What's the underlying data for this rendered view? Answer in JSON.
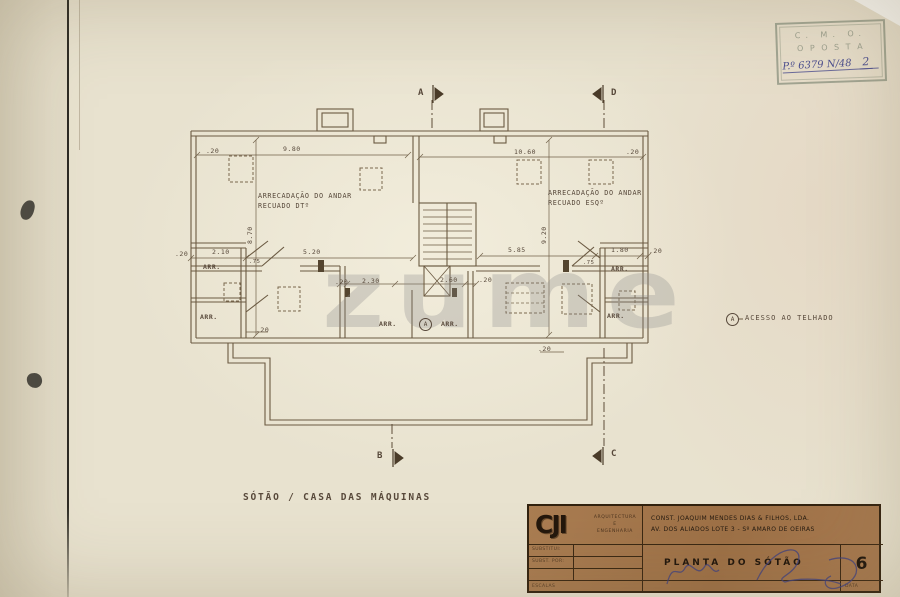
{
  "watermark": {
    "text": "zume"
  },
  "stamp": {
    "line1": "C. M. O.",
    "line2": "O P O S T A",
    "handwritten": "P.º 6379 N/48",
    "number": "2"
  },
  "plan": {
    "texts": [
      {
        "n": "dimension-label",
        "t": ".20",
        "x": 206,
        "y": 147
      },
      {
        "n": "dimension-label",
        "t": "9.80",
        "x": 283,
        "y": 145
      },
      {
        "n": "dimension-label",
        "t": "10.60",
        "x": 514,
        "y": 148
      },
      {
        "n": "dimension-label",
        "t": ".20",
        "x": 626,
        "y": 148
      },
      {
        "n": "dimension-label",
        "t": "8.70",
        "x": 246,
        "y": 244,
        "r": -90
      },
      {
        "n": "dimension-label",
        "t": "9.20",
        "x": 540,
        "y": 244,
        "r": -90
      },
      {
        "n": "dimension-label",
        "t": ".20",
        "x": 175,
        "y": 250
      },
      {
        "n": "dimension-label",
        "t": "2.10",
        "x": 212,
        "y": 248
      },
      {
        "n": "dimension-label",
        "t": ".75",
        "x": 249,
        "y": 259,
        "s": 5.5
      },
      {
        "n": "dimension-label",
        "t": "5.20",
        "x": 303,
        "y": 248
      },
      {
        "n": "dimension-label",
        "t": "5.85",
        "x": 508,
        "y": 246
      },
      {
        "n": "dimension-label",
        "t": ".75",
        "x": 583,
        "y": 260,
        "s": 5.5
      },
      {
        "n": "dimension-label",
        "t": "1.80",
        "x": 611,
        "y": 246
      },
      {
        "n": "dimension-label",
        "t": ".20",
        "x": 649,
        "y": 247
      },
      {
        "n": "dimension-label",
        "t": ".20",
        "x": 335,
        "y": 278
      },
      {
        "n": "dimension-label",
        "t": "2.30",
        "x": 362,
        "y": 277
      },
      {
        "n": "dimension-label",
        "t": "2.60",
        "x": 440,
        "y": 276
      },
      {
        "n": "dimension-label",
        "t": ".20",
        "x": 479,
        "y": 276
      },
      {
        "n": "dimension-label",
        "t": ".20",
        "x": 256,
        "y": 326
      },
      {
        "n": "dimension-label",
        "t": ".20",
        "x": 538,
        "y": 345
      },
      {
        "n": "room-label",
        "t": "ARRECADAÇÃO DO ANDAR",
        "x": 258,
        "y": 192,
        "s": 6.8,
        "ls": 0.6
      },
      {
        "n": "room-label",
        "t": "RECUADO DTº",
        "x": 258,
        "y": 202,
        "s": 6.8,
        "ls": 0.6
      },
      {
        "n": "room-label",
        "t": "ARRECADAÇÃO DO ANDAR",
        "x": 548,
        "y": 189,
        "s": 6.8,
        "ls": 0.6
      },
      {
        "n": "room-label",
        "t": "RECUADO ESQº",
        "x": 548,
        "y": 199,
        "s": 6.8,
        "ls": 0.6
      },
      {
        "n": "room-label",
        "t": "ARR.",
        "x": 203,
        "y": 263,
        "b": true
      },
      {
        "n": "room-label",
        "t": "ARR.",
        "x": 200,
        "y": 313,
        "b": true
      },
      {
        "n": "room-label",
        "t": "ARR.",
        "x": 379,
        "y": 320,
        "b": true
      },
      {
        "n": "room-label",
        "t": "ARR.",
        "x": 441,
        "y": 320,
        "b": true
      },
      {
        "n": "room-label",
        "t": "ARR.",
        "x": 611,
        "y": 265,
        "b": true
      },
      {
        "n": "room-label",
        "t": "ARR.",
        "x": 607,
        "y": 312,
        "b": true
      },
      {
        "n": "section-marker-letter",
        "t": "A",
        "x": 418,
        "y": 88,
        "s": 9,
        "b": true
      },
      {
        "n": "section-marker-letter",
        "t": "D",
        "x": 611,
        "y": 88,
        "s": 9,
        "b": true
      },
      {
        "n": "section-marker-letter",
        "t": "B",
        "x": 377,
        "y": 451,
        "s": 9,
        "b": true
      },
      {
        "n": "section-marker-letter",
        "t": "C",
        "x": 611,
        "y": 449,
        "s": 9,
        "b": true
      },
      {
        "n": "roof-access-marker",
        "t": "A",
        "x": 726,
        "y": 313,
        "s": 6,
        "circle": true
      },
      {
        "n": "roof-access-marker",
        "t": "A",
        "x": 419,
        "y": 318,
        "s": 6,
        "circle": true
      },
      {
        "n": "note-text",
        "t": "ACESSO  AO  TELHADO",
        "x": 745,
        "y": 314,
        "s": 7,
        "ls": 1
      },
      {
        "n": "plan-caption",
        "t": "SÓTÃO / CASA  DAS   MÁQUINAS",
        "x": 243,
        "y": 492,
        "s": 9.5,
        "ls": 1.8,
        "b": true
      }
    ]
  },
  "titleblock": {
    "logo_text": "CJI",
    "firm_line1": "ARQUITECTURA",
    "firm_line2": "E",
    "firm_line3": "ENGENHARIA",
    "company_line1": "CONST. JOAQUIM  MENDES  DIAS & FILHOS, LDA.",
    "company_line2": "AV.  DOS  ALIADOS   LOTE 3 -  Sº AMARO   DE  OEIRAS",
    "row1_label": "SUBSTITUI:",
    "row2_label": "SUBST. POR:",
    "scales_label": "ESCALAS",
    "drawing_title": "PLANTA   DO   SÓTÃO",
    "sheet_number": "6",
    "date_label": "DATA"
  }
}
